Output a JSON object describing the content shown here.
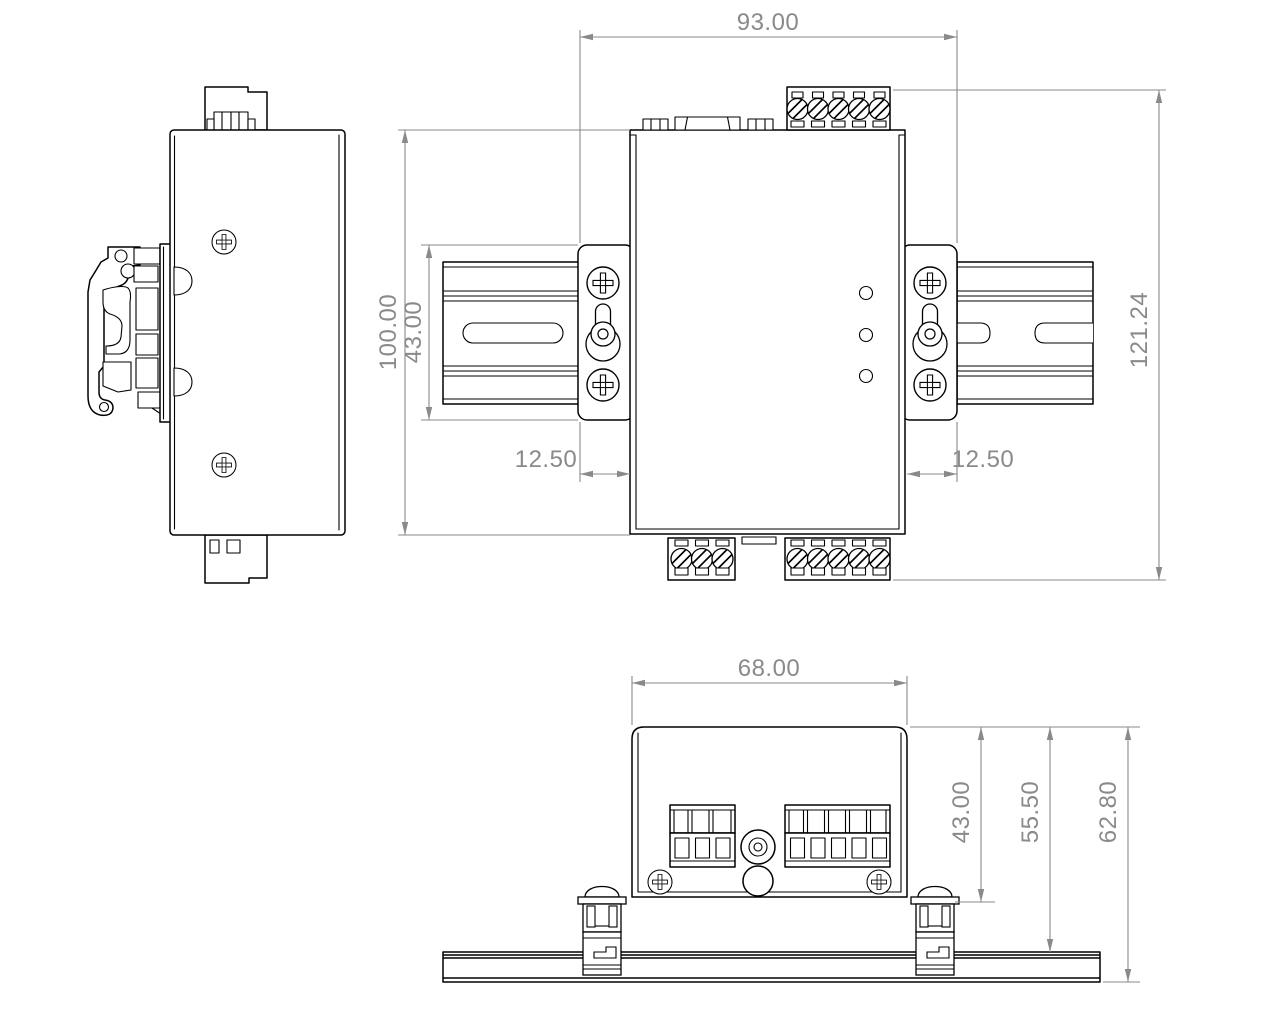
{
  "drawing": {
    "colors": {
      "line": "#000000",
      "dimension": "#8a8a8a",
      "background": "#ffffff"
    },
    "dimensions": {
      "front": {
        "overall_width": "93.00",
        "body_height": "100.00",
        "bracket_height": "43.00",
        "bracket_offset_left": "12.50",
        "bracket_offset_right": "12.50",
        "overall_height": "121.24"
      },
      "bottom": {
        "body_width": "68.00",
        "body_depth": "43.00",
        "depth_to_rail_top": "55.50",
        "overall_depth": "62.80"
      }
    }
  }
}
